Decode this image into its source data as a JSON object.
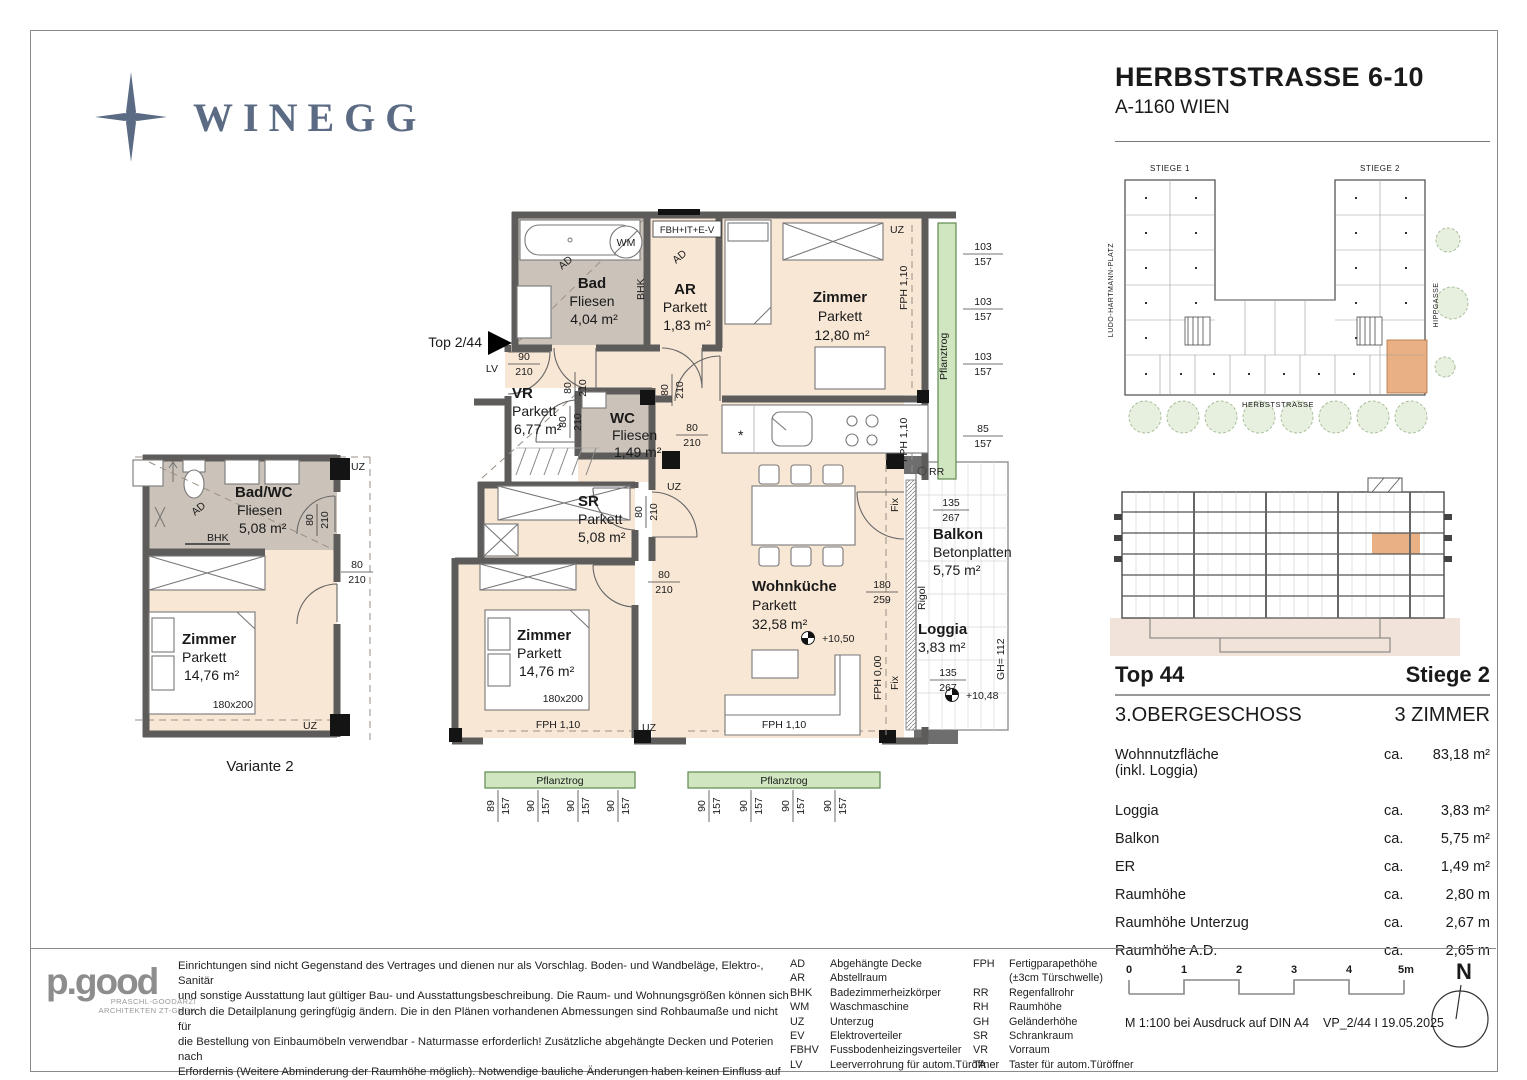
{
  "header": {
    "brand": "WINEGG",
    "title": "HERBSTSTRASSE 6-10",
    "subtitle": "A-1160 WIEN"
  },
  "main_plan": {
    "entry_label": "Top 2/44",
    "rooms": {
      "bad": {
        "name": "Bad",
        "finish": "Fliesen",
        "area": "4,04 m²"
      },
      "ar": {
        "name": "AR",
        "finish": "Parkett",
        "area": "1,83 m²"
      },
      "zimmer1": {
        "name": "Zimmer",
        "finish": "Parkett",
        "area": "12,80 m²"
      },
      "vr": {
        "name": "VR",
        "finish": "Parkett",
        "area": "6,77 m²"
      },
      "wc": {
        "name": "WC",
        "finish": "Fliesen",
        "area": "1,49 m²"
      },
      "sr": {
        "name": "SR",
        "finish": "Parkett",
        "area": "5,08 m²"
      },
      "wohnkueche": {
        "name": "Wohnküche",
        "finish": "Parkett",
        "area": "32,58 m²"
      },
      "zimmer2": {
        "name": "Zimmer",
        "finish": "Parkett",
        "area": "14,76 m²"
      },
      "balkon": {
        "name": "Balkon",
        "finish": "Betonplatten",
        "area": "5,75 m²"
      },
      "loggia": {
        "name": "Loggia",
        "area": "3,83 m²"
      }
    },
    "labels": {
      "ad": "AD",
      "wm": "WM",
      "bhk": "BHK",
      "uz": "UZ",
      "lv": "LV",
      "rr": "RR",
      "fix": "Fix",
      "rigol": "Rigol",
      "gh": "GH= 112",
      "fph110": "FPH 1,10",
      "fph000": "FPH 0,00",
      "pflanztrog": "Pflanztrog",
      "fbh_box": "FBH+IT+E-V",
      "bed_size": "180x200",
      "kitchen_symbol": "*"
    },
    "levels": {
      "upper": "+10,50",
      "lower": "+10,48"
    },
    "dims": {
      "entry": [
        "90",
        "210"
      ],
      "door": [
        "80",
        "210"
      ],
      "win_balkon": [
        "135",
        "267"
      ],
      "win_terrace": [
        "180",
        "259"
      ],
      "right": [
        [
          "103",
          "157"
        ],
        [
          "103",
          "157"
        ],
        [
          "103",
          "157"
        ],
        [
          "85",
          "157"
        ]
      ],
      "bottom_left": [
        [
          "89",
          "157"
        ],
        [
          "90",
          "157"
        ],
        [
          "90",
          "157"
        ],
        [
          "90",
          "157"
        ]
      ],
      "bottom_right": [
        [
          "90",
          "157"
        ],
        [
          "90",
          "157"
        ],
        [
          "90",
          "157"
        ],
        [
          "90",
          "157"
        ]
      ]
    }
  },
  "variante": {
    "caption": "Variante 2",
    "badwc": {
      "name": "Bad/WC",
      "finish": "Fliesen",
      "area": "5,08 m²"
    },
    "zimmer": {
      "name": "Zimmer",
      "finish": "Parkett",
      "area": "14,76 m²"
    }
  },
  "site_plan": {
    "stiege1": "STIEGE 1",
    "stiege2": "STIEGE 2",
    "street_left": "LUDO-HARTMANN-PLATZ",
    "street_right": "HIPPGASSE",
    "street_bottom": "HERBSTSTRASSE"
  },
  "info": {
    "top": "Top 44",
    "stiege": "Stiege 2",
    "floor": "3.OBERGESCHOSS",
    "rooms": "3 ZIMMER",
    "rows": [
      {
        "label": "Wohnnutzfläche",
        "label2": "(inkl. Loggia)",
        "prefix": "ca.",
        "value": "83,18 m²"
      },
      {
        "label": "Loggia",
        "prefix": "ca.",
        "value": "3,83 m²"
      },
      {
        "label": "Balkon",
        "prefix": "ca.",
        "value": "5,75 m²"
      },
      {
        "label": "ER",
        "prefix": "ca.",
        "value": "1,49 m²"
      },
      {
        "label": "Raumhöhe",
        "prefix": "ca.",
        "value": "2,80 m"
      },
      {
        "label": "Raumhöhe Unterzug",
        "prefix": "ca.",
        "value": "2,67 m"
      },
      {
        "label": "Raumhöhe A.D.",
        "prefix": "ca.",
        "value": "2,65 m"
      }
    ]
  },
  "footer": {
    "architect": {
      "logo": "p.good",
      "line1": "PRASCHL-GOODARZI",
      "line2": "ARCHITEKTEN ZT-GMBH"
    },
    "disclaimer_lines": [
      "Einrichtungen sind nicht Gegenstand des Vertrages und dienen nur als Vorschlag. Boden- und Wandbeläge, Elektro-, Sanitär",
      "und sonstige Ausstattung laut gültiger Bau- und Ausstattungsbeschreibung. Die Raum- und Wohnungsgrößen können sich",
      "durch die Detailplanung geringfügig ändern. Die in den Plänen vorhandenen Abmessungen sind Rohbaumaße und nicht für",
      "die Bestellung von Einbaumöbeln verwendbar - Naturmasse erforderlich! Zusätzliche abgehängte Decken und Poterien nach",
      "Erfordernis (Weitere Abminderung der Raumhöhe möglich). Notwendige bauliche Änderungen haben keinen Einfluss auf den",
      "vereinbarten Kaufpreis. Unverbindliche Plankopie. Druckfehler, Irrtum oder Änderungen vorbehalten."
    ],
    "abbr_col1": [
      {
        "k": "AD",
        "v": "Abgehängte Decke"
      },
      {
        "k": "AR",
        "v": "Abstellraum"
      },
      {
        "k": "BHK",
        "v": "Badezimmerheizkörper"
      },
      {
        "k": "WM",
        "v": "Waschmaschine"
      },
      {
        "k": "UZ",
        "v": "Unterzug"
      },
      {
        "k": "EV",
        "v": "Elektroverteiler"
      },
      {
        "k": "FBHV",
        "v": "Fussbodenheizingsverteiler"
      },
      {
        "k": "LV",
        "v": "Leerverrohrung für autom.Türöffner"
      }
    ],
    "abbr_col2": [
      {
        "k": "FPH",
        "v": "Fertigparapethöhe",
        "v2": "(±3cm Türschwelle)"
      },
      {
        "k": "RR",
        "v": "Regenfallrohr"
      },
      {
        "k": "RH",
        "v": "Raumhöhe"
      },
      {
        "k": "GH",
        "v": "Geländerhöhe"
      },
      {
        "k": "SR",
        "v": "Schrankraum"
      },
      {
        "k": "VR",
        "v": "Vorraum"
      },
      {
        "k": "TA",
        "v": "Taster für autom.Türöffner"
      }
    ],
    "scale": {
      "t0": "0",
      "t1": "1",
      "t2": "2",
      "t3": "3",
      "t4": "4",
      "t5": "5m",
      "note": "M 1:100 bei Ausdruck auf DIN A4",
      "version": "VP_2/44 I 19.05.2025"
    },
    "north": "N"
  }
}
